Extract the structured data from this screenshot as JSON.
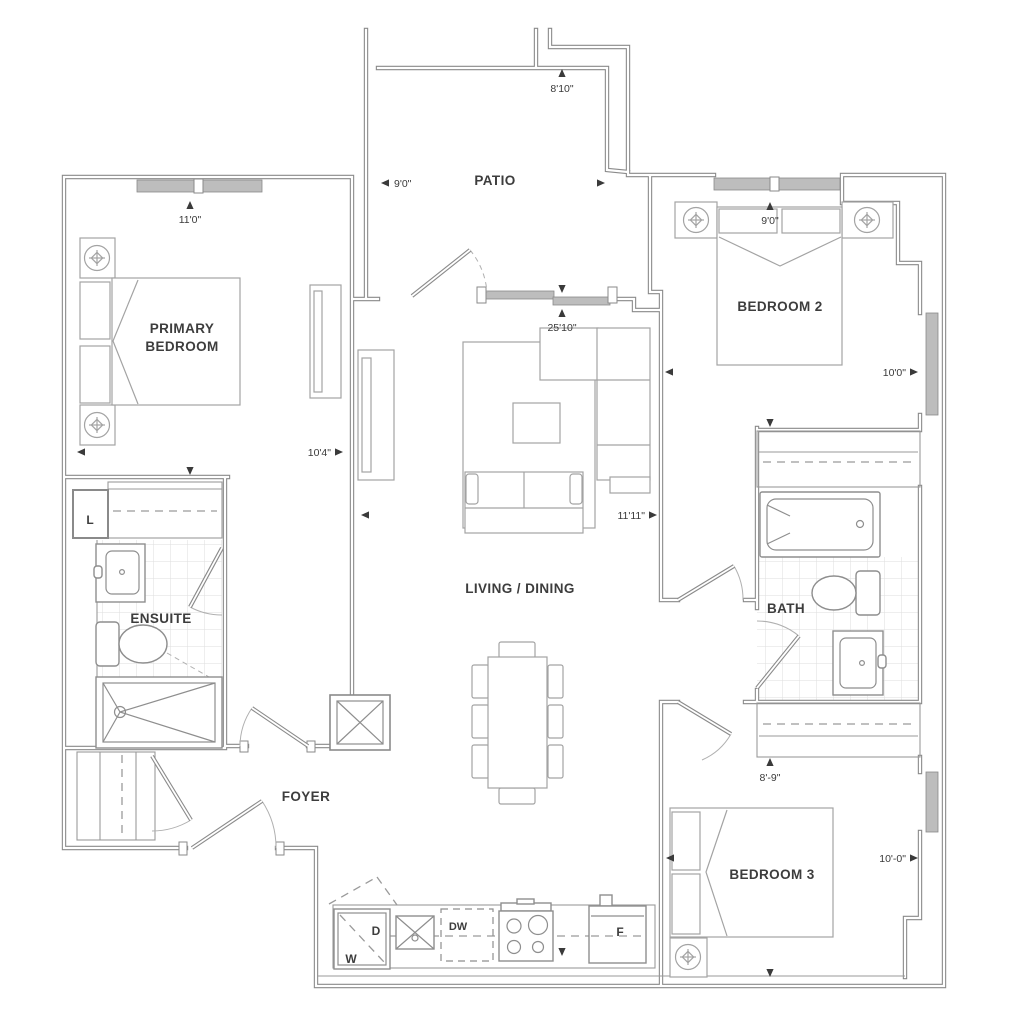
{
  "floor_plan": {
    "rooms": {
      "patio": "PATIO",
      "primary_line1": "PRIMARY",
      "primary_line2": "BEDROOM",
      "bedroom2": "BEDROOM 2",
      "living_dining": "LIVING / DINING",
      "ensuite": "ENSUITE",
      "bath": "BATH",
      "foyer": "FOYER",
      "bedroom3": "BEDROOM 3"
    },
    "dims": {
      "patio_w": "9'0\"",
      "patio_d": "8'10\"",
      "primary_w": "10'4\"",
      "primary_d": "11'0\"",
      "bedroom2_w": "10'0\"",
      "bedroom2_d": "9'0\"",
      "living_w": "11'11\"",
      "living_d": "25'10\"",
      "bedroom3_w": "10'-0\"",
      "bedroom3_d": "8'-9\""
    },
    "appliances": {
      "washer": "W",
      "dryer": "D",
      "dishwasher": "DW",
      "fridge": "F",
      "linen": "L"
    }
  }
}
